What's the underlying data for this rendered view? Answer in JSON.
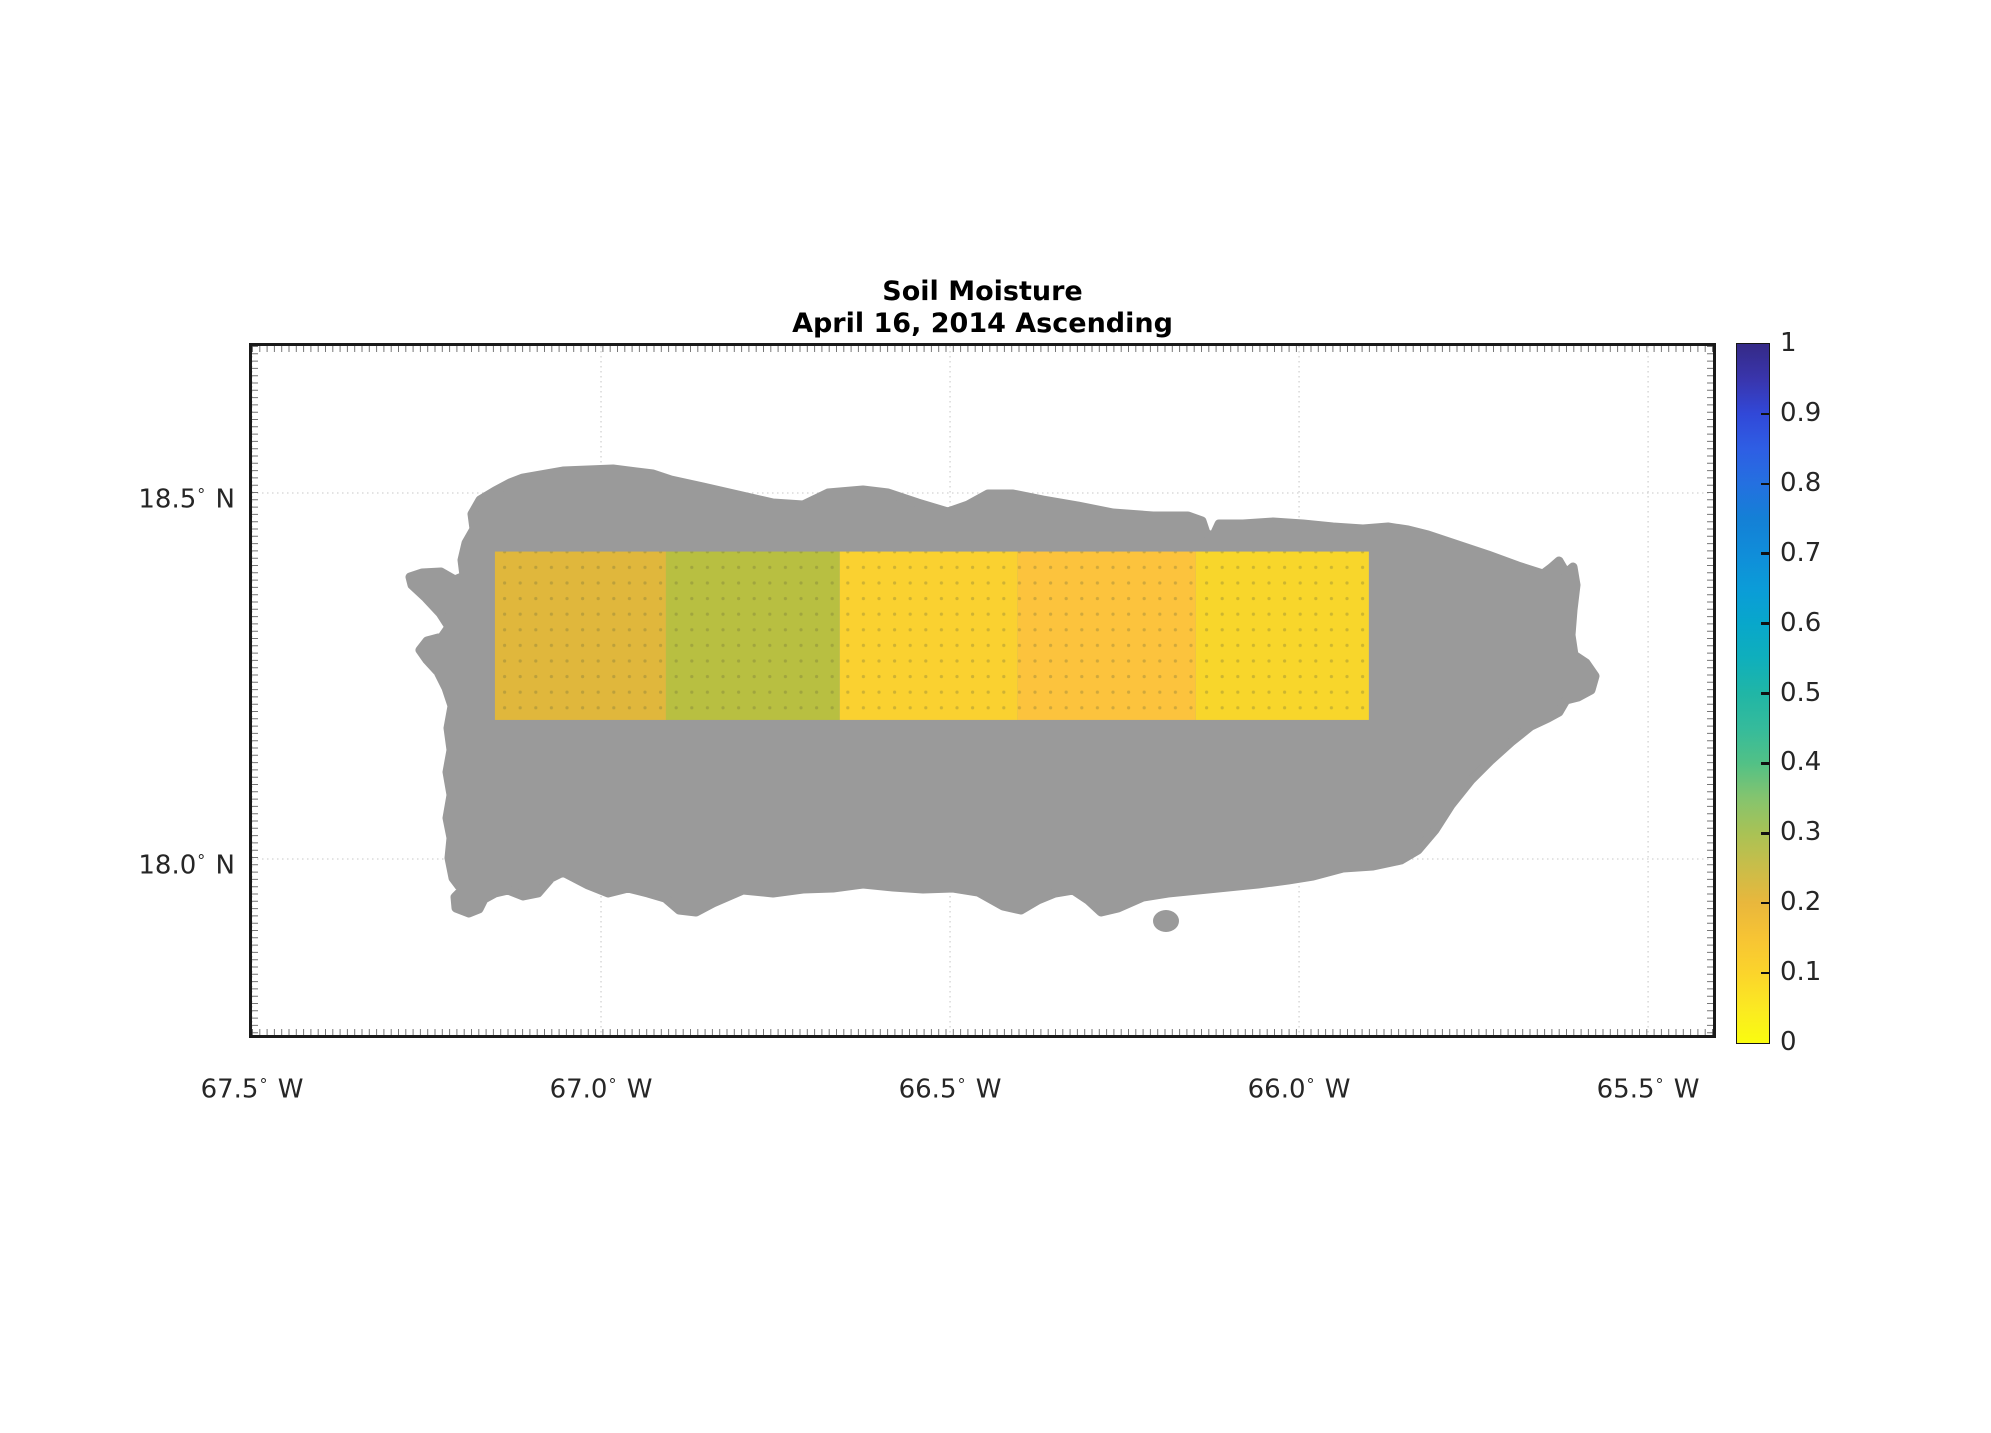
{
  "figure": {
    "title_lines": [
      "Soil Moisture",
      "April 16, 2014 Ascending"
    ],
    "background": "#ffffff",
    "text_color": "#262626",
    "axes_border_color": "#1a1a1a",
    "grid_color": "#d2d2d2"
  },
  "map": {
    "island_color": "#9a9a9a",
    "degree_symbol": "°",
    "xlim_lon": [
      -67.5,
      -65.407
    ],
    "ylim_lat": [
      17.7596,
      18.7008
    ],
    "x_ticks": [
      {
        "value": "67.5",
        "hemi": "W",
        "lon_west": 67.5
      },
      {
        "value": "67.0",
        "hemi": "W",
        "lon_west": 67.0
      },
      {
        "value": "66.5",
        "hemi": "W",
        "lon_west": 66.5
      },
      {
        "value": "66.0",
        "hemi": "W",
        "lon_west": 66.0
      },
      {
        "value": "65.5",
        "hemi": "W",
        "lon_west": 65.5
      }
    ],
    "y_ticks": [
      {
        "value": "18.5",
        "hemi": "N",
        "lat": 18.5
      },
      {
        "value": "18.0",
        "hemi": "N",
        "lat": 18.0
      }
    ]
  },
  "colorbar": {
    "min": 0,
    "max": 1,
    "tick_values": [
      1,
      0.9,
      0.8,
      0.7,
      0.6,
      0.5,
      0.4,
      0.3,
      0.2,
      0.1,
      0
    ],
    "tick_labels": [
      "1",
      "0.9",
      "0.8",
      "0.7",
      "0.6",
      "0.5",
      "0.4",
      "0.3",
      "0.2",
      "0.1",
      "0"
    ],
    "stops": [
      {
        "pos": 0.0,
        "color": "#fafc0f"
      },
      {
        "pos": 0.05,
        "color": "#fbe922"
      },
      {
        "pos": 0.1,
        "color": "#fbd42b"
      },
      {
        "pos": 0.15,
        "color": "#f7c434"
      },
      {
        "pos": 0.2,
        "color": "#e9b73c"
      },
      {
        "pos": 0.25,
        "color": "#cabd49"
      },
      {
        "pos": 0.3,
        "color": "#a9c255"
      },
      {
        "pos": 0.35,
        "color": "#85c46e"
      },
      {
        "pos": 0.4,
        "color": "#52c186"
      },
      {
        "pos": 0.45,
        "color": "#35bb9b"
      },
      {
        "pos": 0.5,
        "color": "#20b6a6"
      },
      {
        "pos": 0.55,
        "color": "#0fafbc"
      },
      {
        "pos": 0.6,
        "color": "#08a7cb"
      },
      {
        "pos": 0.65,
        "color": "#0b9cd8"
      },
      {
        "pos": 0.7,
        "color": "#108dd9"
      },
      {
        "pos": 0.75,
        "color": "#1480d6"
      },
      {
        "pos": 0.8,
        "color": "#2470e0"
      },
      {
        "pos": 0.85,
        "color": "#2e5ee4"
      },
      {
        "pos": 0.9,
        "color": "#3148d8"
      },
      {
        "pos": 0.95,
        "color": "#3935ac"
      },
      {
        "pos": 1.0,
        "color": "#352a87"
      }
    ]
  },
  "chart_data": {
    "type": "heatmap",
    "title": "Soil Moisture",
    "subtitle": "April 16, 2014 Ascending",
    "geography": "Puerto Rico landmask (gray)",
    "x_tick_labels": [
      "67.5° W",
      "67.0° W",
      "66.5° W",
      "66.0° W",
      "65.5° W"
    ],
    "y_tick_labels": [
      "18.5° N",
      "18.0° N"
    ],
    "xlim_deg_west": [
      67.5,
      65.41
    ],
    "ylim_deg_north": [
      17.76,
      18.7
    ],
    "grid": true,
    "legend_position": "right-colorbar",
    "colorbar_range": [
      0,
      1
    ],
    "colorbar_ticks": [
      0,
      0.1,
      0.2,
      0.3,
      0.4,
      0.5,
      0.6,
      0.7,
      0.8,
      0.9,
      1
    ],
    "colormap": "yellow-to-blue (reversed parula)",
    "band": {
      "lat_south": 18.19,
      "lat_north": 18.42,
      "segments": [
        {
          "lon_west": 67.152,
          "lon_east": 66.907,
          "color": "#e0b73c",
          "soil_moisture_est": 0.21
        },
        {
          "lon_west": 66.907,
          "lon_east": 66.658,
          "color": "#b8bf41",
          "soil_moisture_est": 0.28
        },
        {
          "lon_west": 66.658,
          "lon_east": 66.403,
          "color": "#fad130",
          "soil_moisture_est": 0.1
        },
        {
          "lon_west": 66.403,
          "lon_east": 66.148,
          "color": "#fcc33d",
          "soil_moisture_est": 0.15
        },
        {
          "lon_west": 66.148,
          "lon_east": 65.9,
          "color": "#f8d62b",
          "soil_moisture_est": 0.08
        }
      ]
    }
  }
}
